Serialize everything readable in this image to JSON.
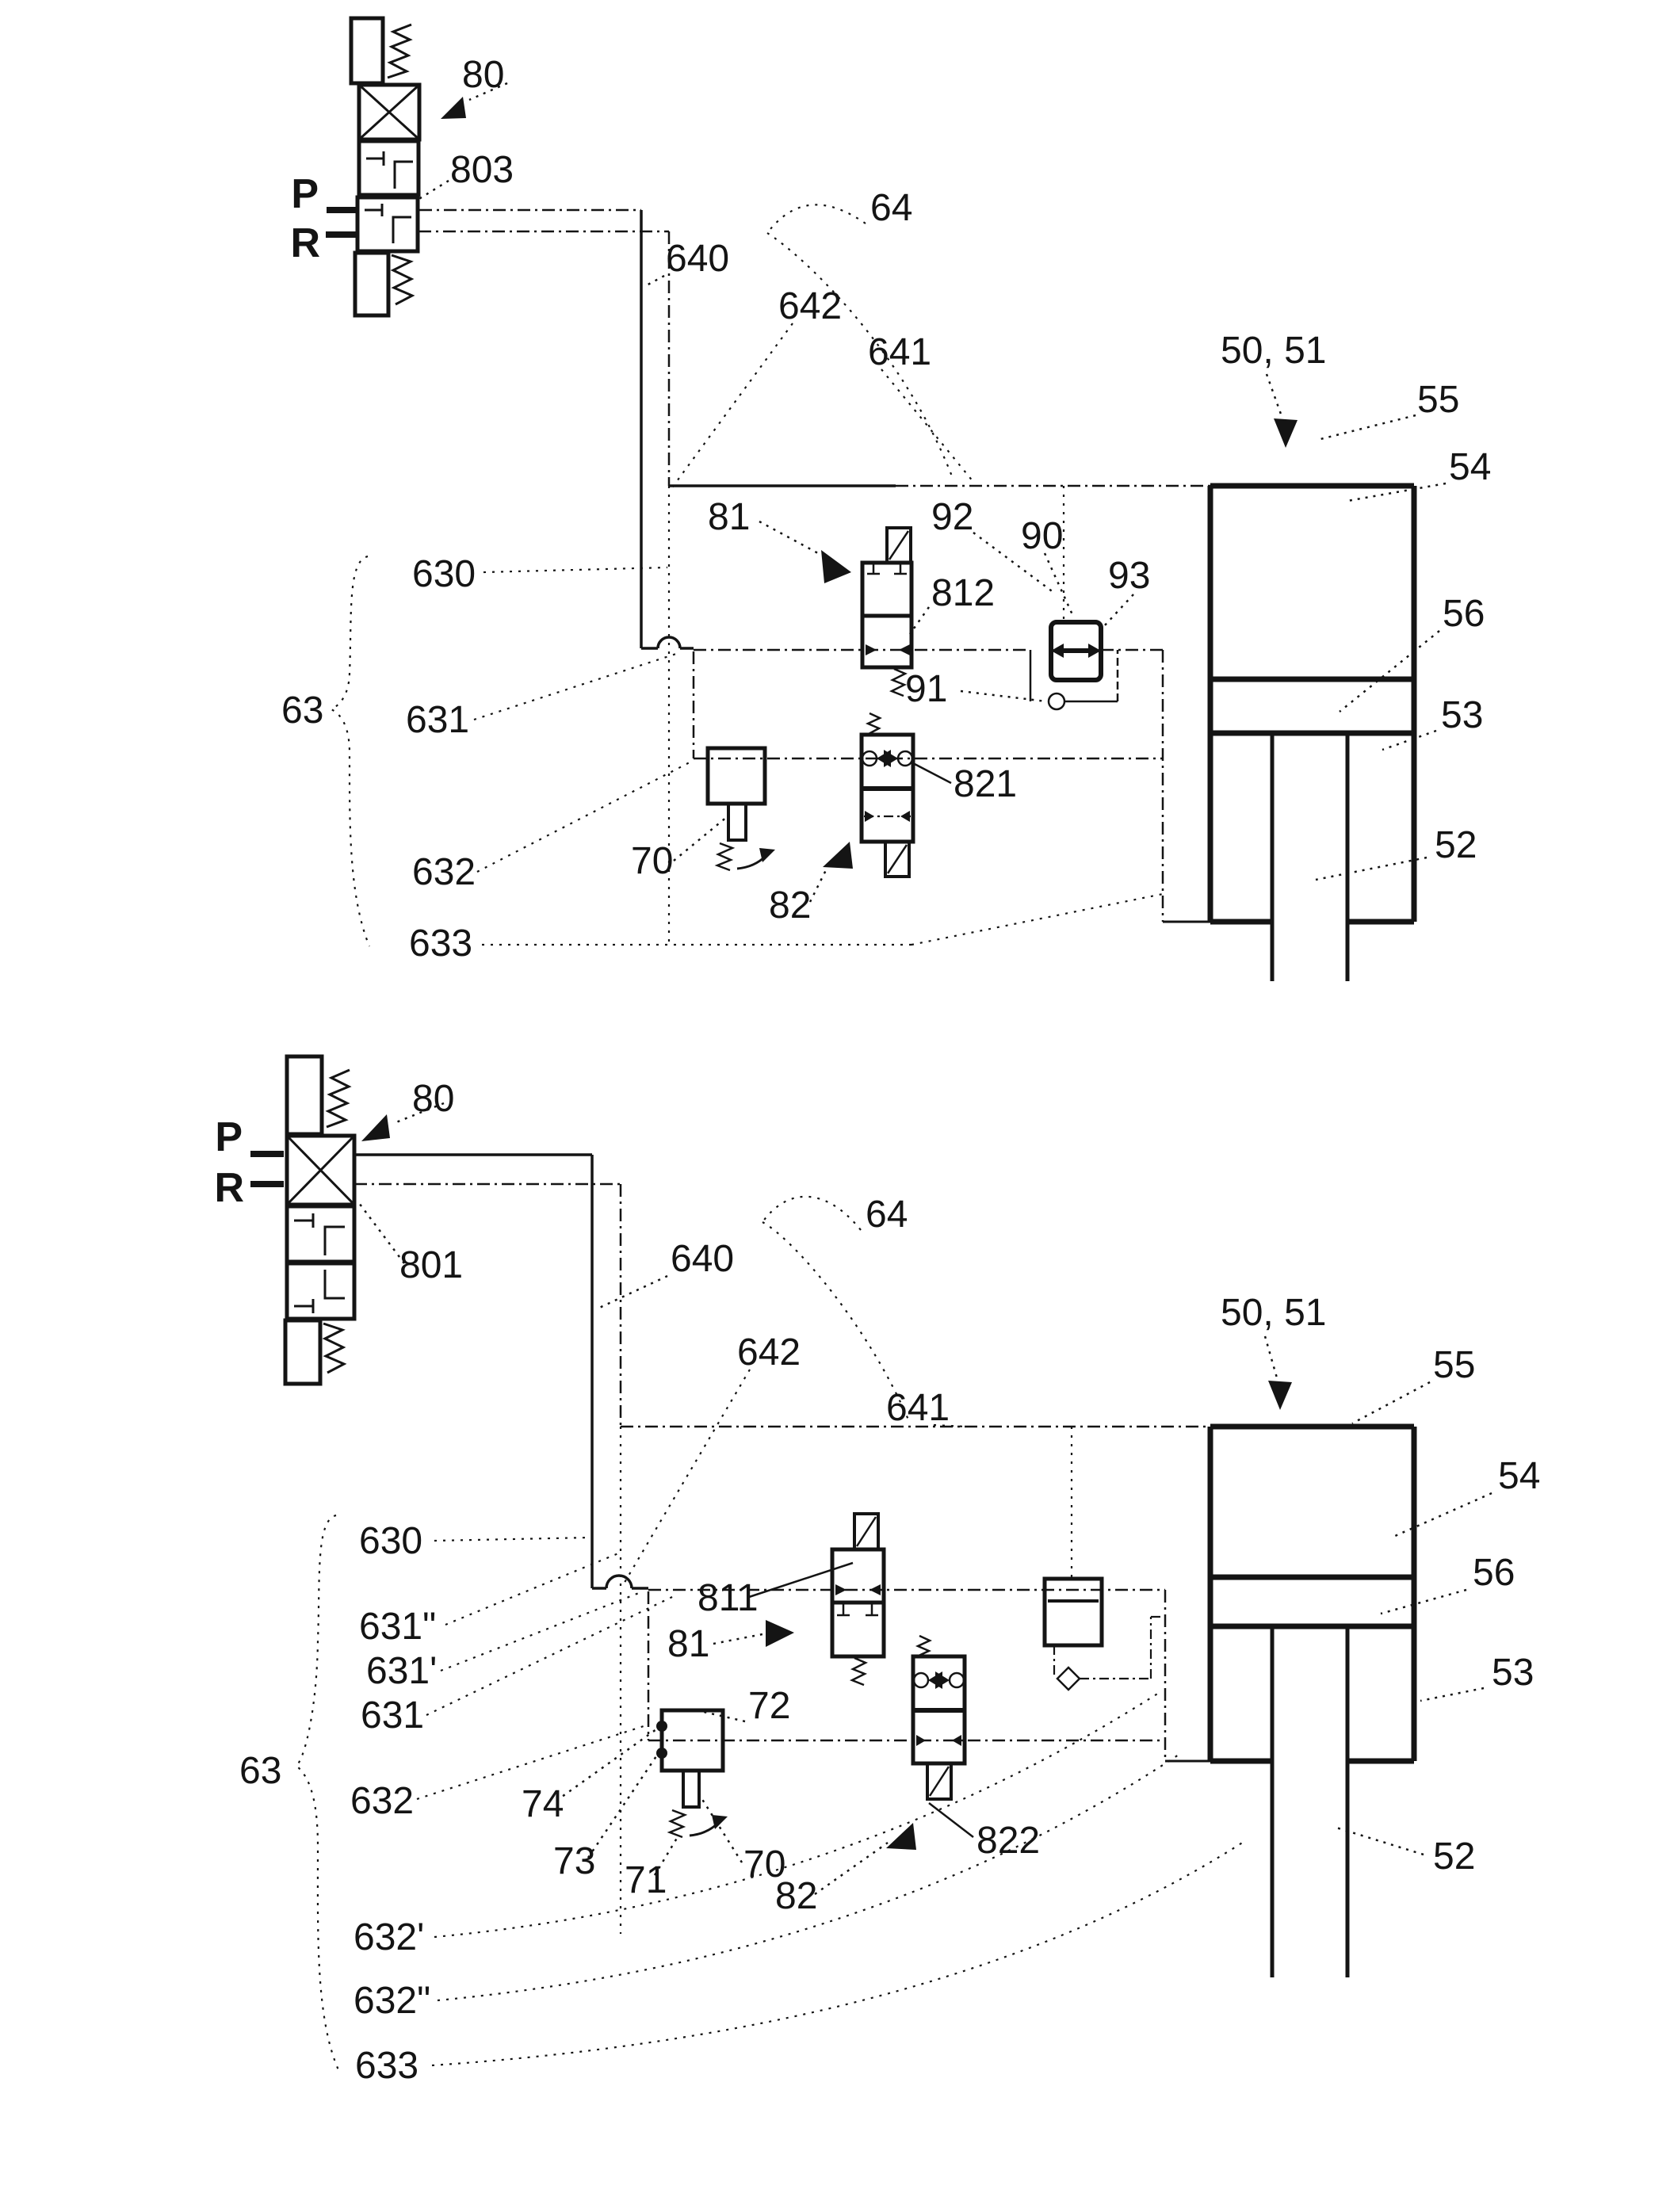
{
  "figure": {
    "type": "pneumatic-circuit-patent-diagram",
    "top": {
      "l80": "80",
      "l803": "803",
      "p": "P",
      "r": "R",
      "l640": "640",
      "l64": "64",
      "l642": "642",
      "l641": "641",
      "l50_51": "50, 51",
      "l55": "55",
      "l54": "54",
      "l56": "56",
      "l53": "53",
      "l52": "52",
      "l630": "630",
      "l63": "63",
      "l631": "631",
      "l632": "632",
      "l633": "633",
      "l81": "81",
      "l812": "812",
      "l92": "92",
      "l90": "90",
      "l93": "93",
      "l91": "91",
      "l821": "821",
      "l70": "70",
      "l82": "82"
    },
    "bottom": {
      "l80": "80",
      "l801": "801",
      "p": "P",
      "r": "R",
      "l640": "640",
      "l64": "64",
      "l642": "642",
      "l641": "641",
      "l50_51": "50, 51",
      "l55": "55",
      "l54": "54",
      "l56": "56",
      "l53": "53",
      "l52": "52",
      "l630": "630",
      "l631dd": "631\"",
      "l631d": "631'",
      "l631": "631",
      "l63": "63",
      "l632": "632",
      "l74": "74",
      "l73": "73",
      "l71": "71",
      "l70": "70",
      "l72": "72",
      "l811": "811",
      "l81": "81",
      "l82": "82",
      "l822": "822",
      "l632d": "632'",
      "l632dd": "632\"",
      "l633": "633"
    }
  }
}
